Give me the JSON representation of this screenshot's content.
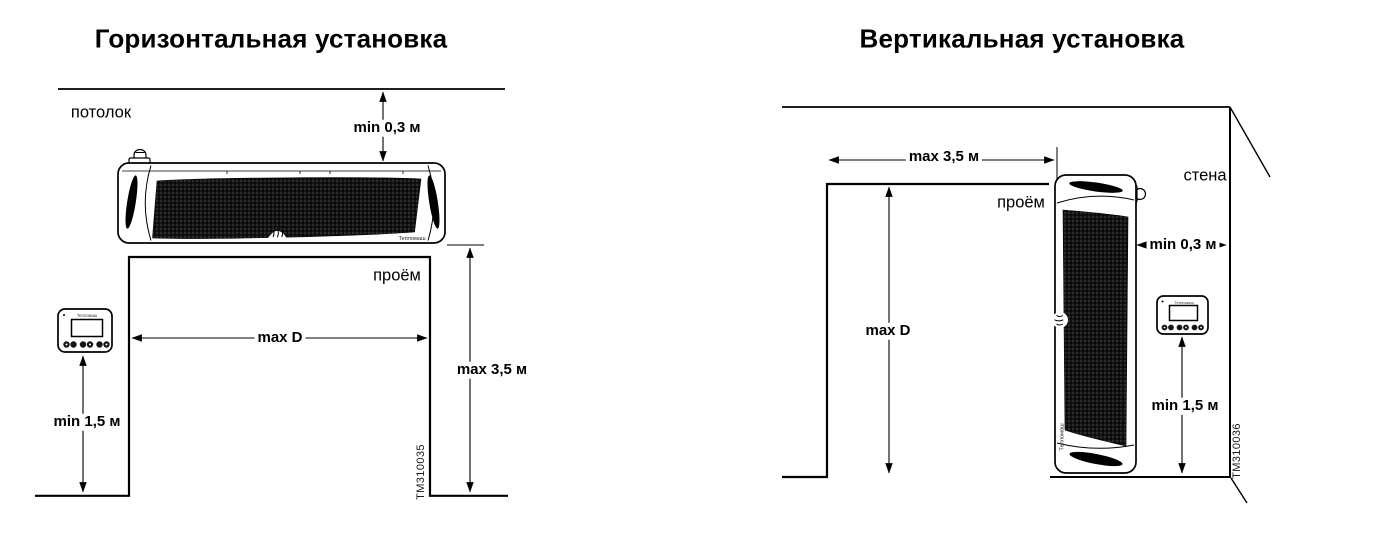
{
  "page": {
    "width": 1380,
    "height": 537,
    "background": "#ffffff"
  },
  "colors": {
    "line": "#000000",
    "grille_dark": "#141414",
    "text": "#000000"
  },
  "left_diagram": {
    "title": "Горизонтальная установка",
    "drawing_number": "TM310035",
    "device_brand": "Тепломаш",
    "labels": {
      "ceiling": "потолок",
      "opening": "проём",
      "ceiling_clearance": "min 0,3 м",
      "opening_width": "max D",
      "opening_height": "max 3,5 м",
      "controller_height": "min 1,5 м"
    }
  },
  "right_diagram": {
    "title": "Вертикальная установка",
    "drawing_number": "TM310036",
    "device_brand": "Тепломаш",
    "labels": {
      "wall": "стена",
      "opening": "проём",
      "opening_width": "max 3,5 м",
      "opening_height": "max D",
      "wall_clearance": "min 0,3 м",
      "controller_height": "min 1,5 м"
    }
  }
}
